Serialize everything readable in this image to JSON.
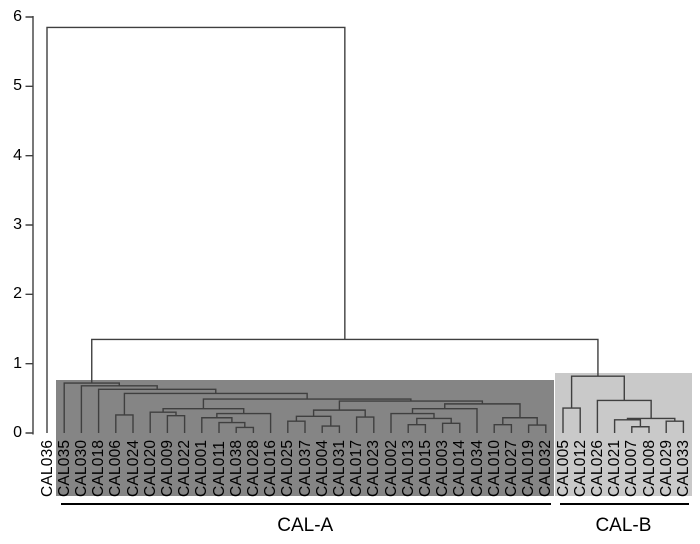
{
  "chart_data": {
    "type": "dendrogram",
    "title": "",
    "yaxis": {
      "label": "",
      "min": 0,
      "max": 6,
      "ticks": [
        0,
        1,
        2,
        3,
        4,
        5,
        6
      ]
    },
    "leaves": [
      "CAL036",
      "CAL035",
      "CAL030",
      "CAL018",
      "CAL006",
      "CAL024",
      "CAL020",
      "CAL009",
      "CAL022",
      "CAL001",
      "CAL011",
      "CAL038",
      "CAL028",
      "CAL016",
      "CAL025",
      "CAL037",
      "CAL004",
      "CAL031",
      "CAL017",
      "CAL023",
      "CAL002",
      "CAL013",
      "CAL015",
      "CAL003",
      "CAL014",
      "CAL034",
      "CAL010",
      "CAL027",
      "CAL019",
      "CAL032",
      "CAL005",
      "CAL012",
      "CAL026",
      "CAL021",
      "CAL007",
      "CAL008",
      "CAL029",
      "CAL033"
    ],
    "tree": {
      "h": 5.85,
      "c": [
        "CAL036",
        {
          "h": 1.35,
          "c": [
            {
              "h": 0.72,
              "c": [
                "CAL035",
                {
                  "h": 0.68,
                  "c": [
                    "CAL030",
                    {
                      "h": 0.63,
                      "c": [
                        "CAL018",
                        {
                          "h": 0.57,
                          "c": [
                            {
                              "h": 0.26,
                              "c": [
                                "CAL006",
                                "CAL024"
                              ]
                            },
                            {
                              "h": 0.49,
                              "c": [
                                {
                                  "h": 0.35,
                                  "c": [
                                    {
                                      "h": 0.3,
                                      "c": [
                                        "CAL020",
                                        {
                                          "h": 0.25,
                                          "c": [
                                            "CAL009",
                                            "CAL022"
                                          ]
                                        }
                                      ]
                                    },
                                    {
                                      "h": 0.28,
                                      "c": [
                                        {
                                          "h": 0.22,
                                          "c": [
                                            "CAL001",
                                            {
                                              "h": 0.15,
                                              "c": [
                                                "CAL011",
                                                {
                                                  "h": 0.08,
                                                  "c": [
                                                    "CAL038",
                                                    "CAL028"
                                                  ]
                                                }
                                              ]
                                            }
                                          ]
                                        },
                                        "CAL016"
                                      ]
                                    }
                                  ]
                                },
                                {
                                  "h": 0.46,
                                  "c": [
                                    {
                                      "h": 0.33,
                                      "c": [
                                        {
                                          "h": 0.24,
                                          "c": [
                                            {
                                              "h": 0.17,
                                              "c": [
                                                "CAL025",
                                                "CAL037"
                                              ]
                                            },
                                            {
                                              "h": 0.1,
                                              "c": [
                                                "CAL004",
                                                "CAL031"
                                              ]
                                            }
                                          ]
                                        },
                                        {
                                          "h": 0.23,
                                          "c": [
                                            "CAL017",
                                            "CAL023"
                                          ]
                                        }
                                      ]
                                    },
                                    {
                                      "h": 0.42,
                                      "c": [
                                        {
                                          "h": 0.35,
                                          "c": [
                                            {
                                              "h": 0.28,
                                              "c": [
                                                "CAL002",
                                                {
                                                  "h": 0.21,
                                                  "c": [
                                                    {
                                                      "h": 0.12,
                                                      "c": [
                                                        "CAL013",
                                                        "CAL015"
                                                      ]
                                                    },
                                                    {
                                                      "h": 0.14,
                                                      "c": [
                                                        "CAL003",
                                                        "CAL014"
                                                      ]
                                                    }
                                                  ]
                                                }
                                              ]
                                            },
                                            "CAL034"
                                          ]
                                        },
                                        {
                                          "h": 0.22,
                                          "c": [
                                            {
                                              "h": 0.12,
                                              "c": [
                                                "CAL010",
                                                "CAL027"
                                              ]
                                            },
                                            {
                                              "h": 0.115,
                                              "c": [
                                                "CAL019",
                                                "CAL032"
                                              ]
                                            }
                                          ]
                                        }
                                      ]
                                    }
                                  ]
                                }
                              ]
                            }
                          ]
                        }
                      ]
                    }
                  ]
                }
              ]
            },
            {
              "h": 0.82,
              "c": [
                {
                  "h": 0.36,
                  "c": [
                    "CAL005",
                    "CAL012"
                  ]
                },
                {
                  "h": 0.47,
                  "c": [
                    "CAL026",
                    {
                      "h": 0.21,
                      "c": [
                        {
                          "h": 0.19,
                          "c": [
                            "CAL021",
                            {
                              "h": 0.09,
                              "c": [
                                "CAL007",
                                "CAL008"
                              ]
                            }
                          ]
                        },
                        {
                          "h": 0.17,
                          "c": [
                            "CAL029",
                            "CAL033"
                          ]
                        }
                      ]
                    }
                  ]
                }
              ]
            }
          ]
        }
      ]
    },
    "groups": [
      {
        "label": "CAL-A",
        "start": "CAL035",
        "end": "CAL032",
        "fill": "#858585"
      },
      {
        "label": "CAL-B",
        "start": "CAL005",
        "end": "CAL033",
        "fill": "#c9c9c9"
      }
    ],
    "colors": {
      "line": "#3f3f3f",
      "text": "#000000",
      "background": "#ffffff"
    },
    "legend": null
  }
}
